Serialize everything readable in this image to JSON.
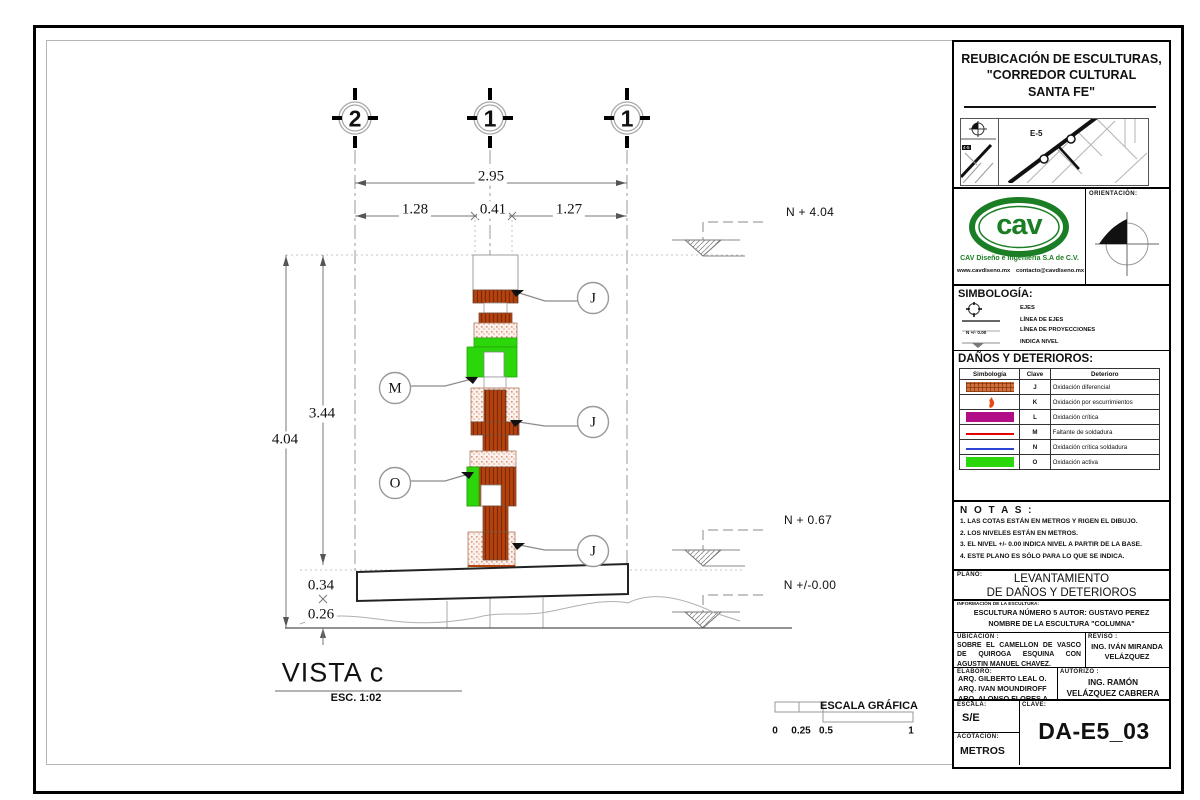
{
  "title_block": {
    "project_title_lines": [
      "REUBICACIÓN DE ESCULTURAS,",
      "\"CORREDOR CULTURAL",
      "SANTA FE\""
    ],
    "map": {
      "area_label": "E-5",
      "mini_label": "4-5"
    },
    "logo": {
      "text": "cav",
      "company": "CAV Diseño e Ingeniería S.A de C.V.",
      "website": "www.cavdiseno.mx",
      "email": "contacto@cavdiseno.mx"
    },
    "orientation_label": "ORIENTACIÓN:",
    "simbologia": {
      "title": "SIMBOLOGÍA:",
      "items": [
        {
          "label": "EJES"
        },
        {
          "label": "LÍNEA DE EJES"
        },
        {
          "label": "LÍNEA DE PROYECCIONES"
        },
        {
          "label": "INDICA NIVEL",
          "symbol_text": "N +/- 0.00"
        }
      ]
    },
    "danos": {
      "title": "DAÑOS Y DETERIOROS:",
      "headers": [
        "Simbología",
        "Clave",
        "Deterioro"
      ],
      "rows": [
        {
          "clave": "J",
          "deterioro": "Oxidación diferencial"
        },
        {
          "clave": "K",
          "deterioro": "Oxidación por escurrimientos"
        },
        {
          "clave": "L",
          "deterioro": "Oxidación crítica"
        },
        {
          "clave": "M",
          "deterioro": "Faltante de soldadura"
        },
        {
          "clave": "N",
          "deterioro": "Oxidación crítica soldadura"
        },
        {
          "clave": "O",
          "deterioro": "Oxidación activa"
        }
      ]
    },
    "notas": {
      "title": "N O T A S :",
      "items": [
        "1. LAS COTAS ESTÁN EN METROS Y RIGEN EL DIBUJO.",
        "2. LOS NIVELES ESTÁN EN METROS.",
        "3. EL NIVEL +/- 0.00 INDICA NIVEL A PARTIR DE LA BASE.",
        "4. ESTE PLANO ES SÓLO PARA LO QUE SE INDICA."
      ]
    },
    "plano": {
      "label": "PLANO:",
      "lines": [
        "LEVANTAMIENTO",
        "DE DAÑOS Y DETERIOROS"
      ]
    },
    "info": {
      "label": "INFORMACIÓN DE LA ESCULTURA:",
      "lines": [
        "ESCULTURA NÚMERO 5 AUTOR: GUSTAVO PEREZ",
        "NOMBRE DE LA ESCULTURA \"COLUMNA\""
      ]
    },
    "ubicacion": {
      "label": "UBICACIÓN :",
      "text": "SOBRE EL CAMELLON DE VASCO DE QUIROGA ESQUINA CON AGUSTIN MANUEL CHAVEZ."
    },
    "reviso": {
      "label": "REVISO :",
      "text": "ING. IVÁN MIRANDA VELÁZQUEZ"
    },
    "elaboro": {
      "label": "ELABORÓ:",
      "names": [
        "ARQ. GILBERTO LEAL O.",
        "ARQ. IVAN MOUNDIROFF",
        "ARQ. ALONSO FLORES A."
      ]
    },
    "autorizo": {
      "label": "AUTORIZÓ :",
      "text": "ING. RAMÓN VELÁZQUEZ CABRERA"
    },
    "escala": {
      "label": "ESCALA:",
      "value": "S/E"
    },
    "acotacion": {
      "label": "ACOTACIÓN:",
      "value": "METROS"
    },
    "clave": {
      "label": "CLAVE:",
      "value": "DA-E5_03"
    }
  },
  "drawing": {
    "axes": [
      "2",
      "1",
      "1"
    ],
    "dims": {
      "total": "2.95",
      "left": "1.28",
      "center": "0.41",
      "right": "1.27",
      "height_total": "4.04",
      "height_upper": "3.44",
      "base": "0.34",
      "below_base": "0.26"
    },
    "levels": [
      "N + 4.04",
      "N + 0.67",
      "N +/-0.00"
    ],
    "callouts": [
      "J",
      "M",
      "J",
      "O",
      "J"
    ],
    "view": {
      "title": "VISTA c",
      "scale": "ESC. 1:02"
    },
    "scale_bar": {
      "title": "ESCALA GRÁFICA",
      "ticks": [
        "0",
        "0.25",
        "0.5",
        "1"
      ]
    }
  },
  "colors": {
    "oxidation_differential": "#b5430e",
    "oxidation_critical": "#b00d86",
    "weld_missing": "#e60000",
    "weld_critical_line": "#2b46d4",
    "oxidation_active": "#2bd60b",
    "logo_green": "#1b7e24"
  }
}
